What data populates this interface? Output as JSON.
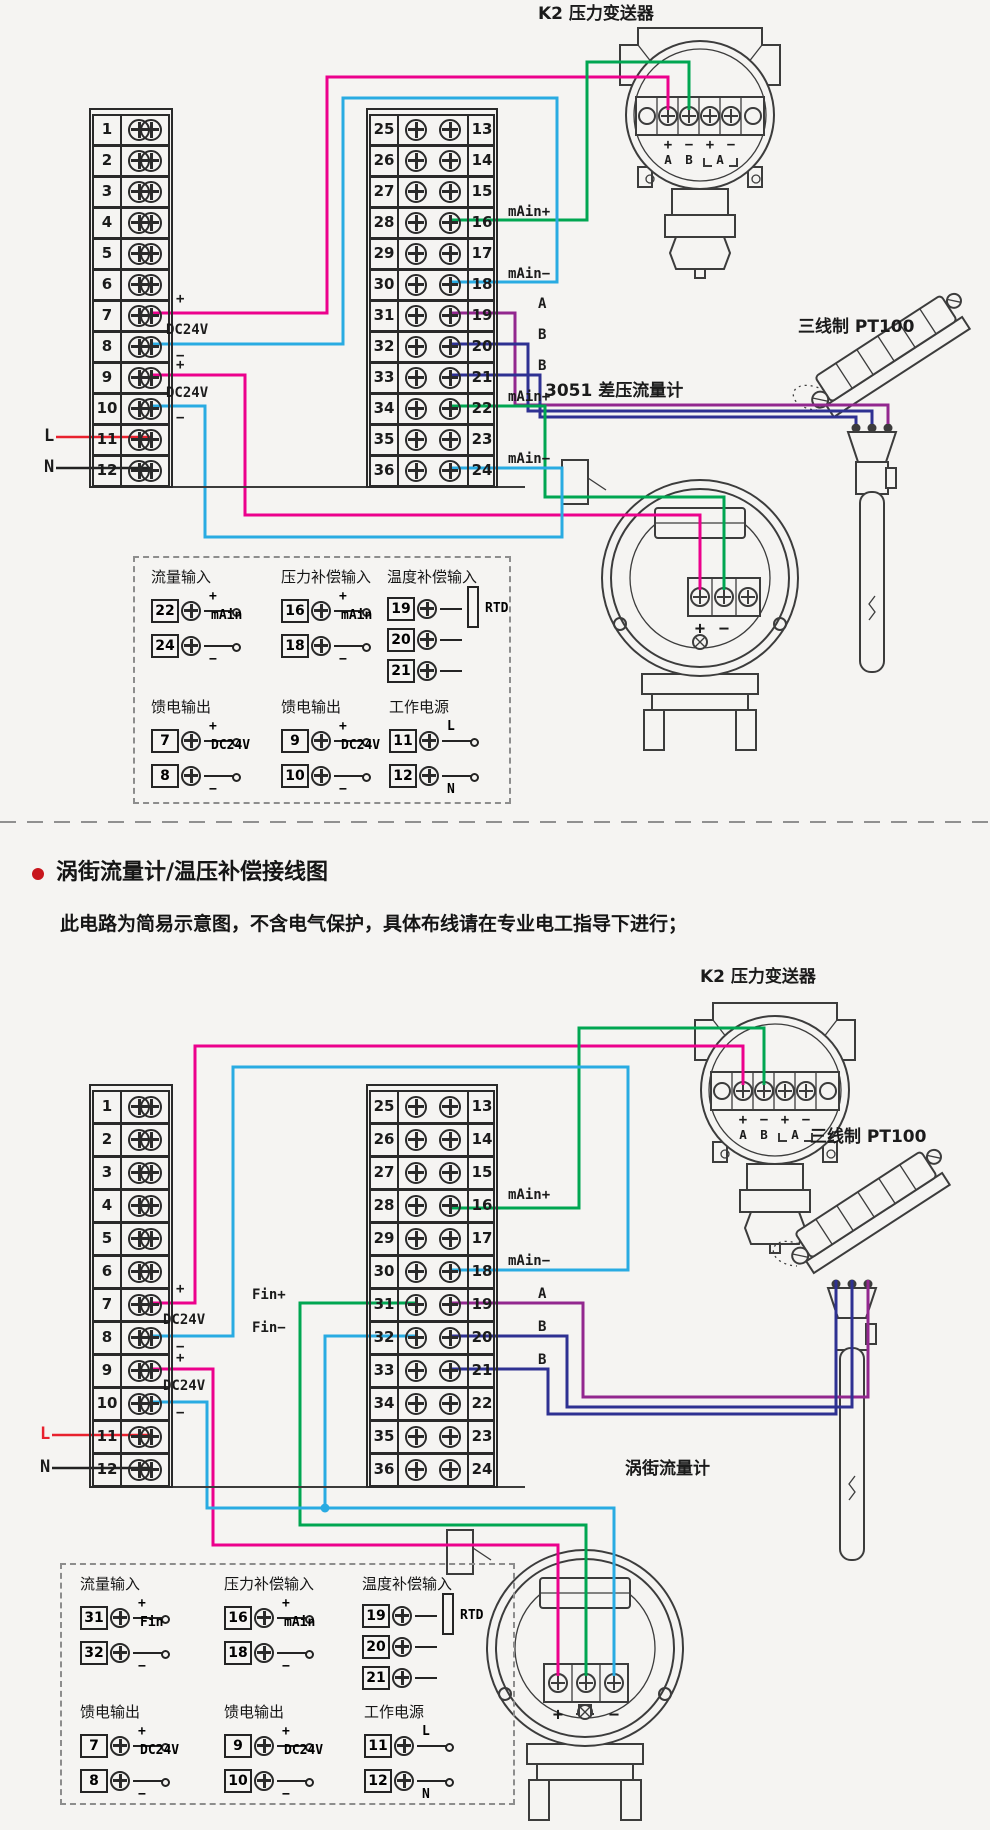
{
  "colors": {
    "bg": "#f5f4f2",
    "magenta": "#ec008c",
    "cyan": "#29abe2",
    "green": "#00a651",
    "purple": "#92278f",
    "navy": "#2e3192",
    "red": "#e8212e",
    "black": "#222222",
    "art": "#3c3c3c",
    "accent": "#c8161d"
  },
  "section2": {
    "title": "涡街流量计/温压补偿接线图",
    "note": "此电路为简易示意图，不含电气保护，具体布线请在专业电工指导下进行；"
  },
  "d1": {
    "k2_label": "K2 压力变送器",
    "pt100_label": "三线制 PT100",
    "meter_label": "3051 差压流量计",
    "left_nums": [
      "1",
      "2",
      "3",
      "4",
      "5",
      "6",
      "7",
      "8",
      "9",
      "10",
      "11",
      "12"
    ],
    "mid_rows": [
      {
        "l": "25",
        "r": "13"
      },
      {
        "l": "26",
        "r": "14"
      },
      {
        "l": "27",
        "r": "15"
      },
      {
        "l": "28",
        "r": "16"
      },
      {
        "l": "29",
        "r": "17"
      },
      {
        "l": "30",
        "r": "18"
      },
      {
        "l": "31",
        "r": "19"
      },
      {
        "l": "32",
        "r": "20"
      },
      {
        "l": "33",
        "r": "21"
      },
      {
        "l": "34",
        "r": "22"
      },
      {
        "l": "35",
        "r": "23"
      },
      {
        "l": "36",
        "r": "24"
      }
    ],
    "labels": {
      "plus7": "+",
      "dc24v_78": "DC24V",
      "minus8": "−",
      "plus9": "+",
      "dc24v_910": "DC24V",
      "minus10": "−",
      "l": "L",
      "n": "N",
      "r16": "mAin+",
      "r18": "mAin−",
      "r19": "A",
      "r20": "B",
      "r21": "B",
      "r22": "mAin+",
      "r24": "mAin−"
    },
    "k2_signs": [
      "+",
      "−",
      "+",
      "−"
    ],
    "k2_ab": [
      "A",
      "B",
      "A"
    ],
    "meter_signs": [
      "+",
      "−"
    ]
  },
  "d2": {
    "k2_label": "K2 压力变送器",
    "pt100_label": "三线制 PT100",
    "meter_label": "涡街流量计",
    "left_nums": [
      "1",
      "2",
      "3",
      "4",
      "5",
      "6",
      "7",
      "8",
      "9",
      "10",
      "11",
      "12"
    ],
    "mid_rows": [
      {
        "l": "25",
        "r": "13"
      },
      {
        "l": "26",
        "r": "14"
      },
      {
        "l": "27",
        "r": "15"
      },
      {
        "l": "28",
        "r": "16"
      },
      {
        "l": "29",
        "r": "17"
      },
      {
        "l": "30",
        "r": "18"
      },
      {
        "l": "31",
        "r": "19"
      },
      {
        "l": "32",
        "r": "20"
      },
      {
        "l": "33",
        "r": "21"
      },
      {
        "l": "34",
        "r": "22"
      },
      {
        "l": "35",
        "r": "23"
      },
      {
        "l": "36",
        "r": "24"
      }
    ],
    "labels": {
      "fin_plus": "Fin+",
      "fin_minus": "Fin−",
      "plus7": "+",
      "dc24v_78": "DC24V",
      "minus8": "−",
      "plus9": "+",
      "dc24v_910": "DC24V",
      "minus10": "−",
      "l": "L",
      "n": "N",
      "r16": "mAin+",
      "r18": "mAin−",
      "r19": "A",
      "r20": "B",
      "r21": "B"
    },
    "k2_signs": [
      "+",
      "−",
      "+",
      "−"
    ],
    "k2_ab": [
      "A",
      "B",
      "A"
    ],
    "meter_signs": [
      "+",
      "−"
    ]
  },
  "legend1": {
    "g1": {
      "title": "流量输入",
      "mid": "mAin",
      "rows": [
        {
          "num": "22",
          "side": "+"
        },
        {
          "num": "24",
          "side": "−"
        }
      ]
    },
    "g2": {
      "title": "压力补偿输入",
      "mid": "mAin",
      "rows": [
        {
          "num": "16",
          "side": "+"
        },
        {
          "num": "18",
          "side": "−"
        }
      ]
    },
    "g3": {
      "title": "温度补偿输入",
      "mid": "RTD",
      "rows": [
        {
          "num": "19"
        },
        {
          "num": "20"
        },
        {
          "num": "21"
        }
      ]
    },
    "g4": {
      "title": "馈电输出",
      "mid": "DC24V",
      "rows": [
        {
          "num": "7",
          "side": "+"
        },
        {
          "num": "8",
          "side": "−"
        }
      ]
    },
    "g5": {
      "title": "馈电输出",
      "mid": "DC24V",
      "rows": [
        {
          "num": "9",
          "side": "+"
        },
        {
          "num": "10",
          "side": "−"
        }
      ]
    },
    "g6": {
      "title": "工作电源",
      "mid": "",
      "rows": [
        {
          "num": "11",
          "side": "L"
        },
        {
          "num": "12",
          "side": "N"
        }
      ]
    }
  },
  "legend2": {
    "g1": {
      "title": "流量输入",
      "mid": "Fin",
      "rows": [
        {
          "num": "31",
          "side": "+"
        },
        {
          "num": "32",
          "side": "−"
        }
      ]
    },
    "g2": {
      "title": "压力补偿输入",
      "mid": "mAin",
      "rows": [
        {
          "num": "16",
          "side": "+"
        },
        {
          "num": "18",
          "side": "−"
        }
      ]
    },
    "g3": {
      "title": "温度补偿输入",
      "mid": "RTD",
      "rows": [
        {
          "num": "19"
        },
        {
          "num": "20"
        },
        {
          "num": "21"
        }
      ]
    },
    "g4": {
      "title": "馈电输出",
      "mid": "DC24V",
      "rows": [
        {
          "num": "7",
          "side": "+"
        },
        {
          "num": "8",
          "side": "−"
        }
      ]
    },
    "g5": {
      "title": "馈电输出",
      "mid": "DC24V",
      "rows": [
        {
          "num": "9",
          "side": "+"
        },
        {
          "num": "10",
          "side": "−"
        }
      ]
    },
    "g6": {
      "title": "工作电源",
      "mid": "",
      "rows": [
        {
          "num": "11",
          "side": "L"
        },
        {
          "num": "12",
          "side": "N"
        }
      ]
    }
  }
}
